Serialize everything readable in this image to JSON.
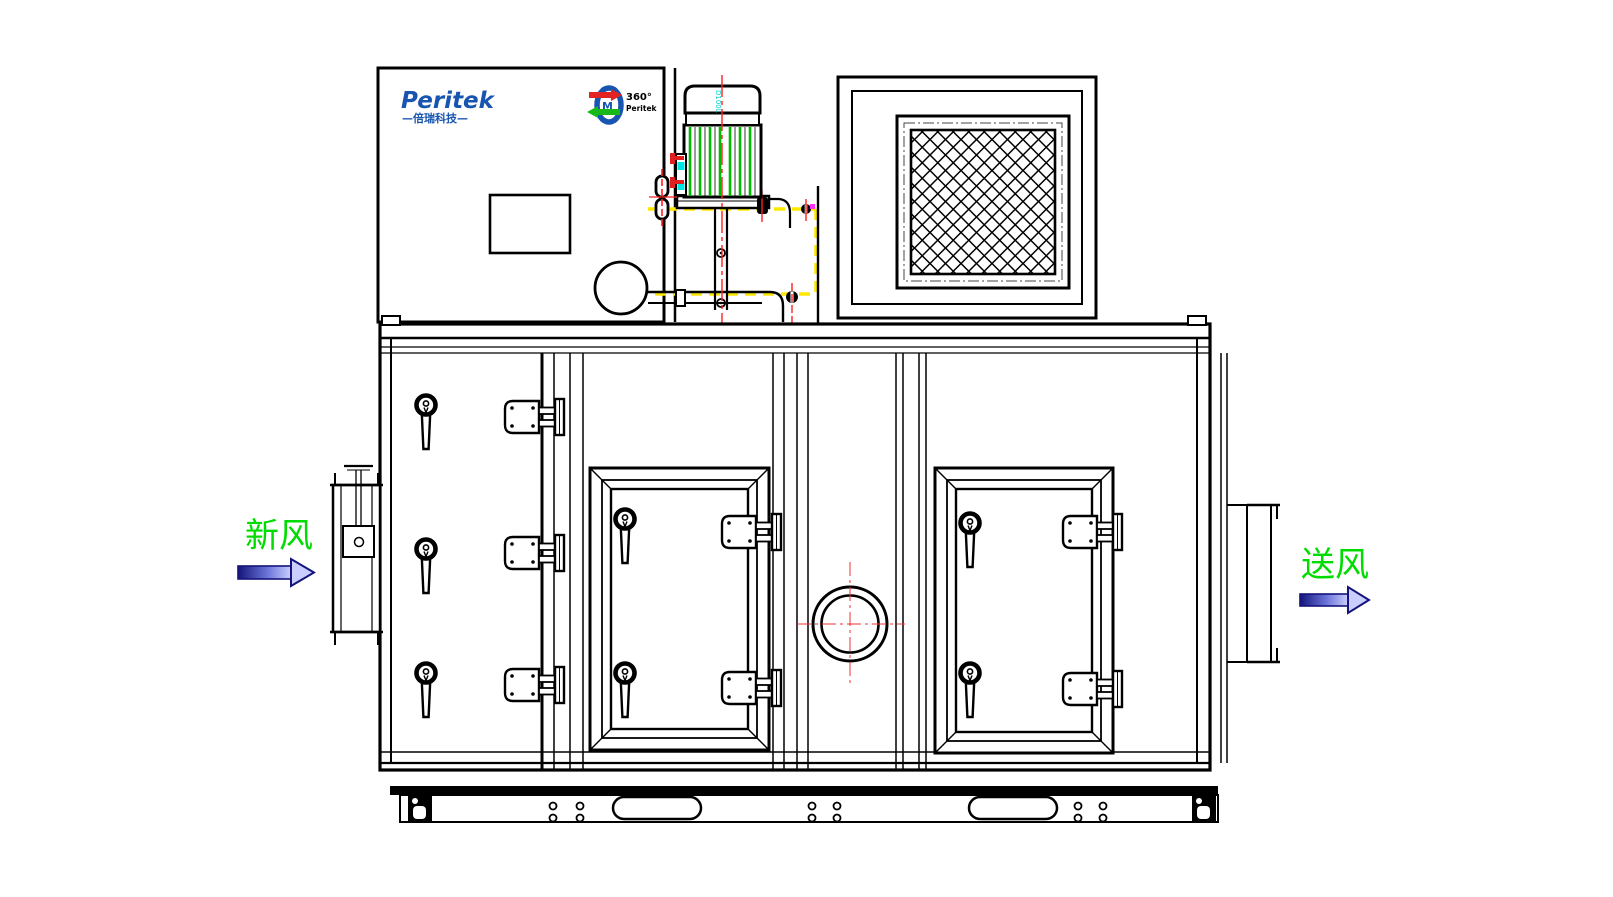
{
  "drawing": {
    "kind": "engineering CAD front-view drawing",
    "equipment": "rotary desiccant dehumidifier air handling unit"
  },
  "brand": {
    "name": "Peritek",
    "tagline": "—倍瑞科技—",
    "rotor_logo": {
      "degrees_text": "360°",
      "brand_text": "Peritek"
    }
  },
  "motor": {
    "frame_label": "D100L"
  },
  "labels": {
    "fresh_air": "新风",
    "supply_air": "送风"
  },
  "annotations": {
    "fresh_air_arrow_direction": "right-into-unit-left-side",
    "supply_air_arrow_direction": "right-out-of-unit-right-side"
  },
  "colors": {
    "line_black": "#000000",
    "brand_blue": "#1855B0",
    "label_green": "#00DC00",
    "centerline_red": "#FF2020",
    "hidden_line_yellow": "#FFE800",
    "motor_fin_green": "#00BB00",
    "accent_cyan": "#00CCCC",
    "arrow_navy": "#14147A",
    "arrow_fill_light": "#C9CEFF",
    "magenta_mark": "#FF30FF",
    "logo_arrow_red": "#E32222",
    "logo_arrow_green": "#18B818"
  }
}
